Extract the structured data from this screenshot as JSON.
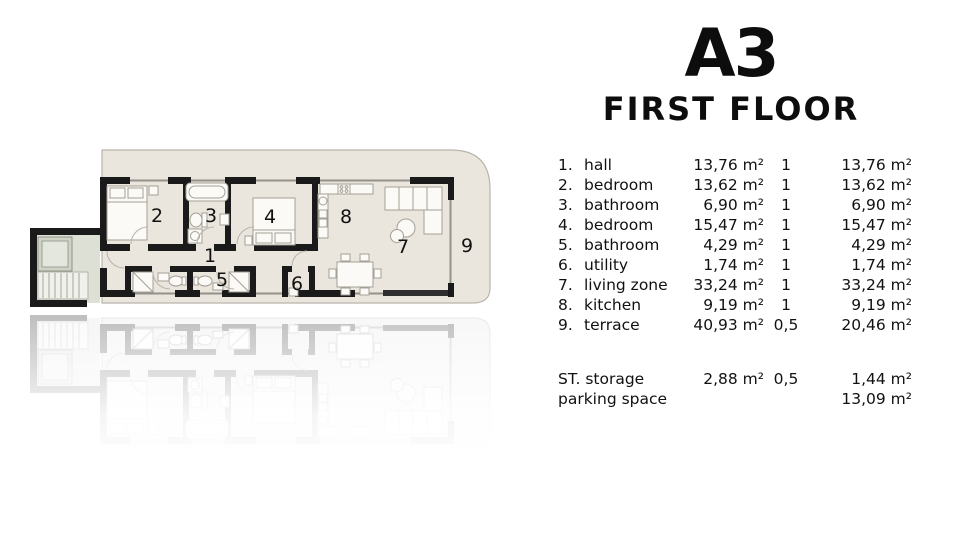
{
  "title": {
    "unit": "A3",
    "floor": "FIRST FLOOR"
  },
  "plan": {
    "labels": [
      "1",
      "2",
      "3",
      "4",
      "5",
      "6",
      "7",
      "8",
      "9"
    ]
  },
  "table": {
    "rows": [
      {
        "num": "1.",
        "name": "hall",
        "area": "13,76 m²",
        "coef": "1",
        "total": "13,76 m²"
      },
      {
        "num": "2.",
        "name": "bedroom",
        "area": "13,62 m²",
        "coef": "1",
        "total": "13,62 m²"
      },
      {
        "num": "3.",
        "name": "bathroom",
        "area": "6,90 m²",
        "coef": "1",
        "total": "6,90 m²"
      },
      {
        "num": "4.",
        "name": "bedroom",
        "area": "15,47 m²",
        "coef": "1",
        "total": "15,47 m²"
      },
      {
        "num": "5.",
        "name": "bathroom",
        "area": "4,29 m²",
        "coef": "1",
        "total": "4,29 m²"
      },
      {
        "num": "6.",
        "name": "utility",
        "area": "1,74 m²",
        "coef": "1",
        "total": "1,74 m²"
      },
      {
        "num": "7.",
        "name": "living zone",
        "area": "33,24 m²",
        "coef": "1",
        "total": "33,24 m²"
      },
      {
        "num": "8.",
        "name": "kitchen",
        "area": "9,19 m²",
        "coef": "1",
        "total": "9,19 m²"
      },
      {
        "num": "9.",
        "name": "terrace",
        "area": "40,93 m²",
        "coef": "0,5",
        "total": "20,46 m²"
      }
    ],
    "extras": [
      {
        "label": "ST. storage",
        "area": "2,88 m²",
        "coef": "0,5",
        "total": "1,44 m²"
      },
      {
        "label": "parking space",
        "area": "",
        "coef": "",
        "total": "13,09 m²"
      }
    ]
  },
  "colors": {
    "wall": "#1a1a1a",
    "floor": "#eae6de",
    "common_area": "#dde1d5",
    "text": "#111111",
    "background": "#ffffff"
  }
}
